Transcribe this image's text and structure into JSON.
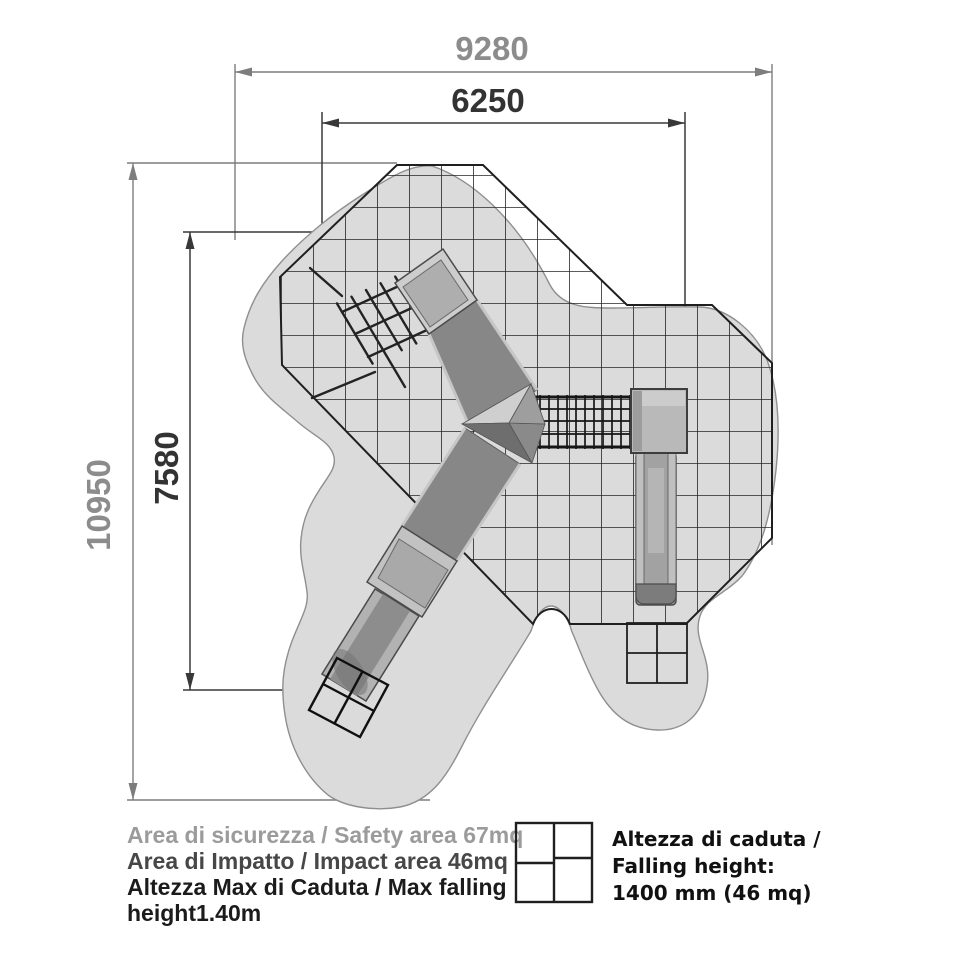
{
  "title": "Playground safety area plan drawing",
  "dimensions": {
    "top_outer": "9280",
    "top_inner": "6250",
    "left_outer": "10950",
    "left_inner": "7580"
  },
  "notes": {
    "line1": "Area di sicurezza / Safety area 67mq",
    "line2": "Area di Impatto / Impact area 46mq",
    "line3": "Altezza Max di Caduta / Max falling",
    "line4": "height1.40m"
  },
  "legend": {
    "icon": "falling-height-grid-icon",
    "line1": "Altezza di caduta /",
    "line2": "Falling height:",
    "line3": "1400 mm (46 mq)"
  },
  "colors": {
    "safety_area_fill": "#dbdbdb",
    "safety_area_outline": "#8f8f8f",
    "impact_grid_line": "#222222",
    "dimension_outer": "#7d7d7d",
    "dimension_inner": "#383838",
    "note_gray": "#9b9b9b",
    "note_mid": "#474747",
    "note_dark": "#1b1b1b",
    "equipment_dark": "#8d8d8d",
    "equipment_light": "#c9c9c9"
  }
}
